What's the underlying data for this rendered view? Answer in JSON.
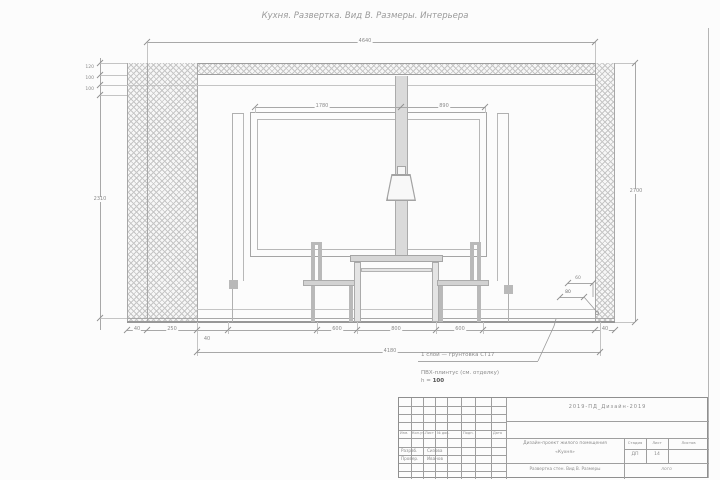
{
  "sheet": {
    "title": "Кухня.   Развертка. Вид В.   Размеры.   Интерьера"
  },
  "dims": {
    "top_width": "4640",
    "panel_left": "1780",
    "panel_right": "890",
    "left_stack": [
      "120",
      "100",
      "100"
    ],
    "left_height": "2310",
    "right_height": "2700",
    "bottom_chain": [
      "40",
      "250",
      "40",
      "600",
      "800",
      "600",
      "40"
    ],
    "bottom_overall": "4180",
    "detail_w": "60",
    "detail_h": "80"
  },
  "notes": {
    "leader": "1 слой — грунтовка СТ17",
    "line2": "ПВХ-плинтус (см. отделку)",
    "line3_label": "h =",
    "line3_value": "100"
  },
  "title_block": {
    "doc_code": "2019-ПД_Дизайн-2019",
    "rev_headers": [
      "Изм.",
      "Кол.уч.",
      "Лист",
      "№ док.",
      "Подп.",
      "Дата"
    ],
    "roles": [
      {
        "label": "Разраб.",
        "name": "Сизова"
      },
      {
        "label": "Провер.",
        "name": "Иванов"
      }
    ],
    "project_line1": "Дизайн-проект жилого помещения",
    "project_line2": "«Кухня»",
    "sheet_caption": "Развертка стен. Вид В. Размеры",
    "stage_header": "Стадия",
    "sheet_header": "Лист",
    "sheets_header": "Листов",
    "stage_value": "ДП",
    "sheet_value": "14",
    "logo": "лого"
  }
}
